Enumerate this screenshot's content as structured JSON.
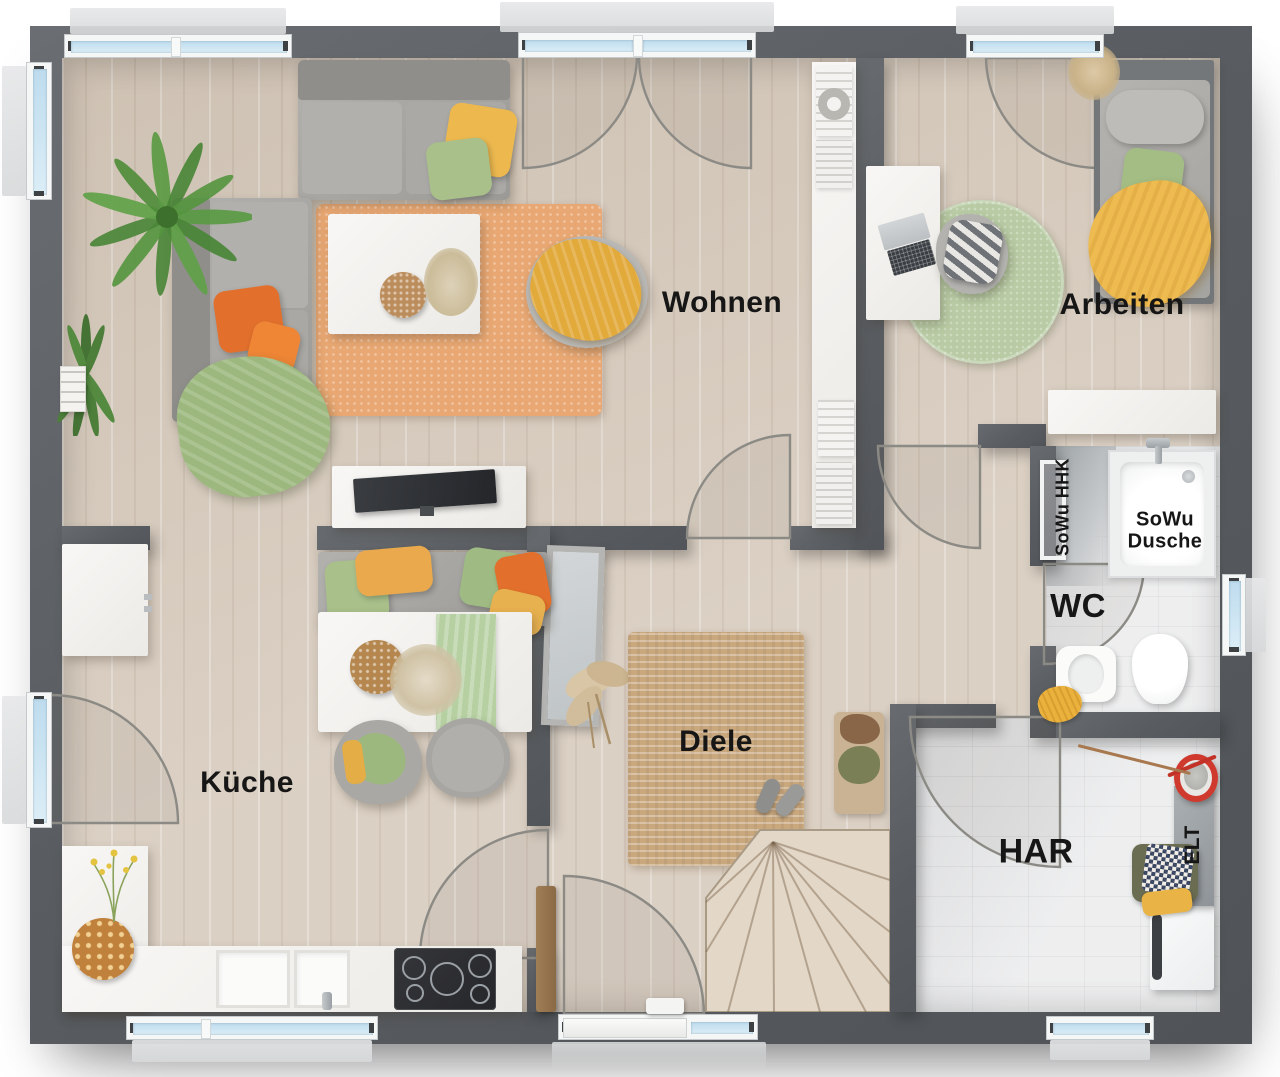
{
  "plan": {
    "title": "floor-plan",
    "rooms": [
      {
        "id": "wohnen",
        "label": "Wohnen"
      },
      {
        "id": "arbeiten",
        "label": "Arbeiten"
      },
      {
        "id": "kueche",
        "label": "Küche"
      },
      {
        "id": "diele",
        "label": "Diele"
      },
      {
        "id": "wc",
        "label": "WC"
      },
      {
        "id": "har",
        "label": "HAR"
      }
    ],
    "annotations": [
      {
        "id": "sowu-dusche",
        "line1": "SoWu",
        "line2": "Dusche"
      },
      {
        "id": "sowu-hhk",
        "label": "SoWu HHK"
      },
      {
        "id": "elt",
        "label": "ELT"
      }
    ],
    "colors": {
      "wall": "#5a5e62",
      "floor_wood": "#d7cbbd",
      "floor_tile": "#e8e9ea",
      "window_glass": "#cfe3f1",
      "rug_orange": "#e9a873",
      "rug_jute": "#c9a87e",
      "rug_green": "#b8cba4",
      "pillow_yellow": "#edb94f",
      "pillow_green": "#a9c08b",
      "pillow_orange": "#e2702c",
      "accent_red": "#d6342c"
    }
  }
}
